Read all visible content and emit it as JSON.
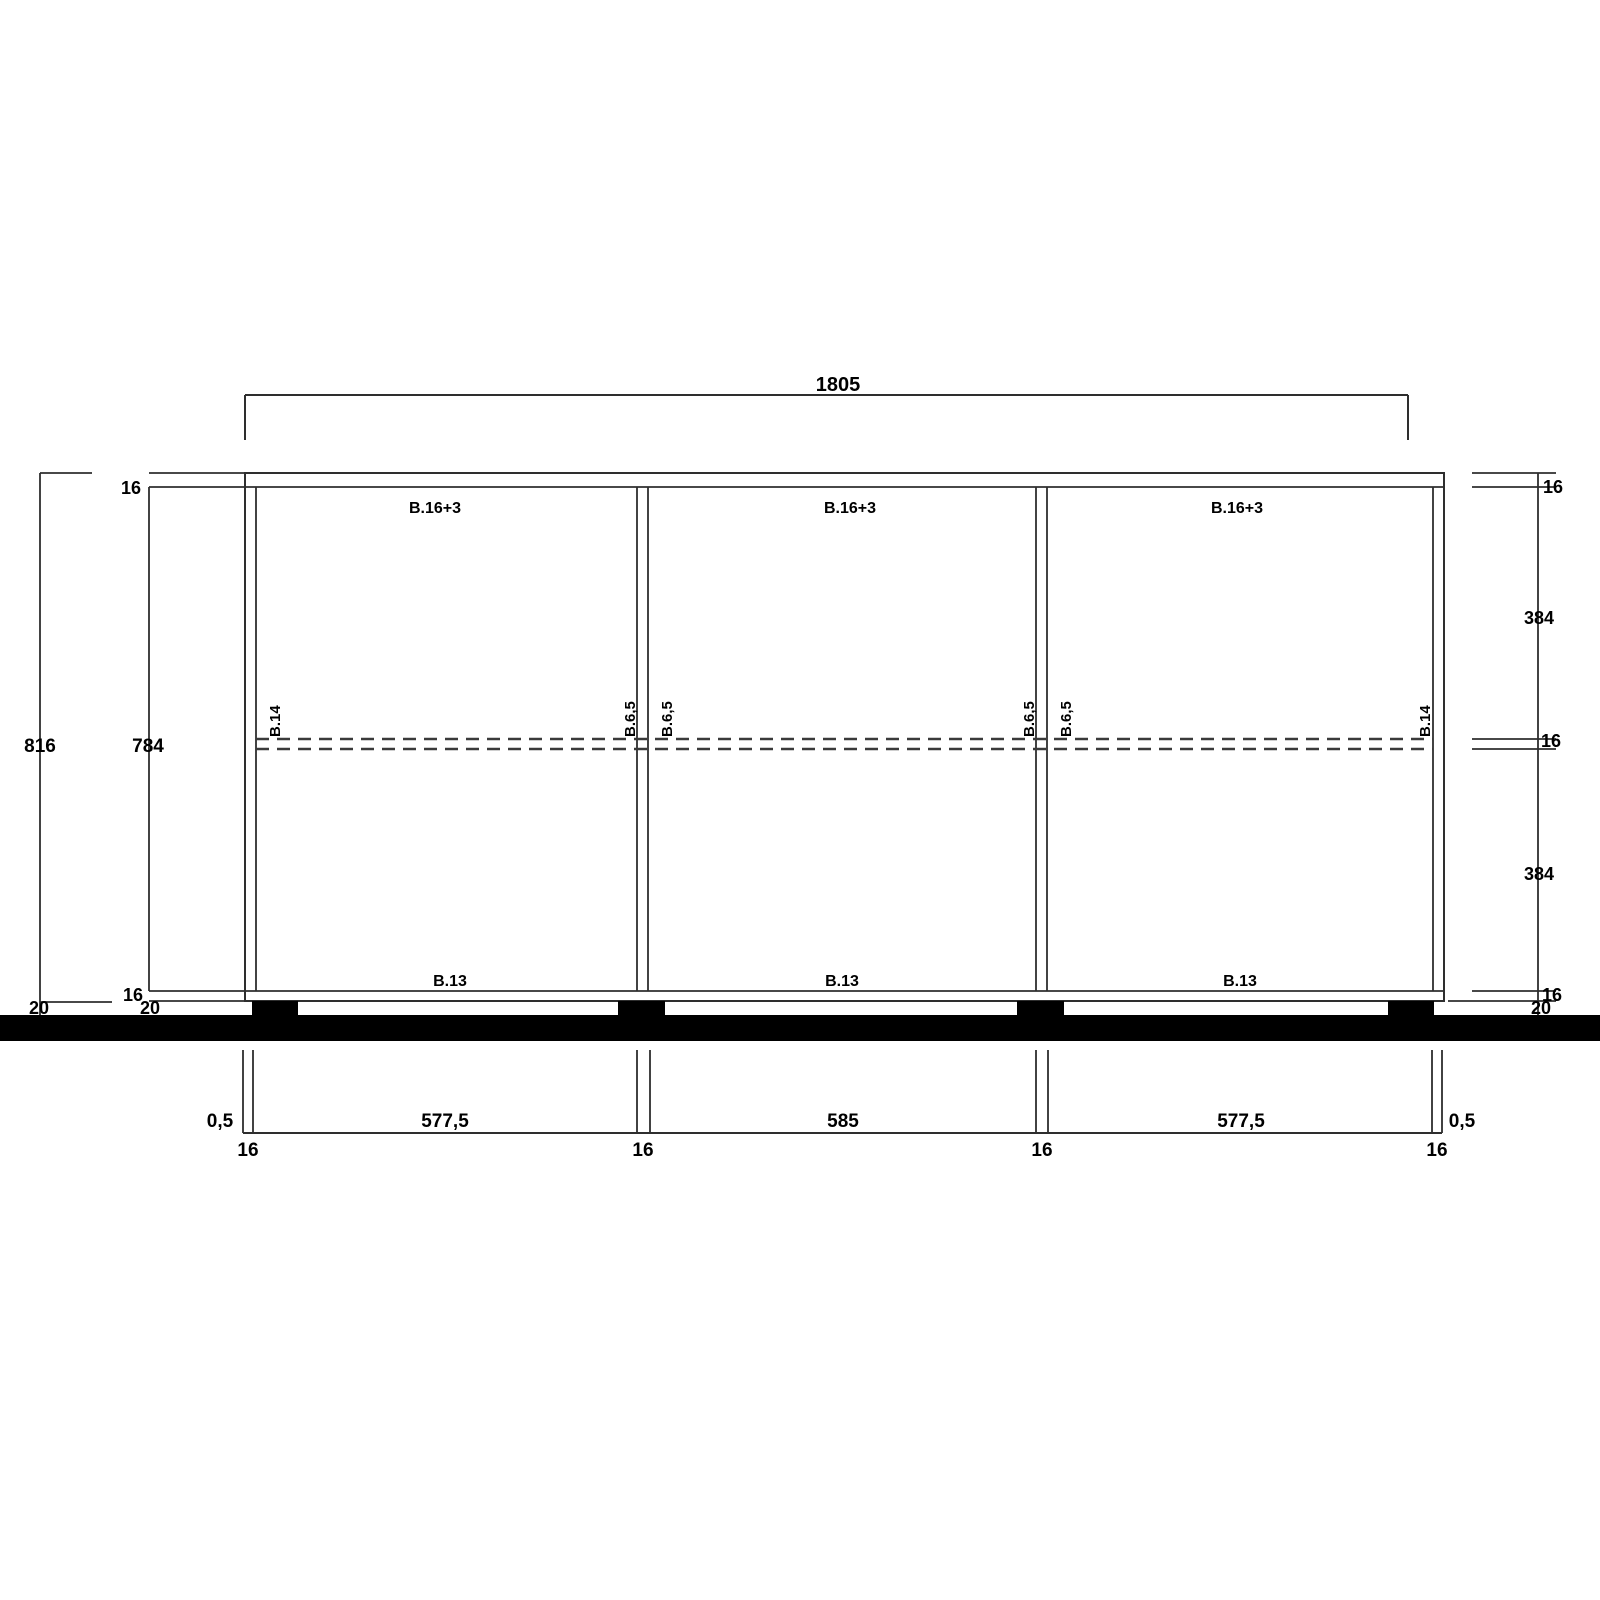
{
  "drawing": {
    "type": "furniture-elevation-technical-drawing",
    "units": "mm"
  },
  "dim_top": {
    "total_width": "1805"
  },
  "dim_left": {
    "overall_height": "816",
    "interior_height": "784",
    "top_panel": "16",
    "bottom_panel": "16",
    "plinth_outer": "20",
    "plinth_inner": "20"
  },
  "dim_right": {
    "top_panel": "16",
    "upper_bay": "384",
    "shelf": "16",
    "lower_bay": "384",
    "bottom_panel": "16",
    "plinth": "20"
  },
  "dim_bottom": {
    "left_edge": "0,5",
    "left_panel": "16",
    "bay_left": "577,5",
    "divider_1": "16",
    "bay_center": "585",
    "divider_2": "16",
    "bay_right": "577,5",
    "right_panel": "16",
    "right_edge": "0,5"
  },
  "parts": {
    "top_panel_labels": [
      "B.16+3",
      "B.16+3",
      "B.16+3"
    ],
    "bottom_panel_labels": [
      "B.13",
      "B.13",
      "B.13"
    ],
    "left_side": "B.14",
    "right_side": "B.14",
    "divider_1_left": "B.6,5",
    "divider_1_right": "B.6,5",
    "divider_2_left": "B.6,5",
    "divider_2_right": "B.6,5"
  },
  "colors": {
    "line": "#2e2e2e",
    "text": "#000000",
    "solid_fill": "#000000",
    "background": "#ffffff"
  }
}
